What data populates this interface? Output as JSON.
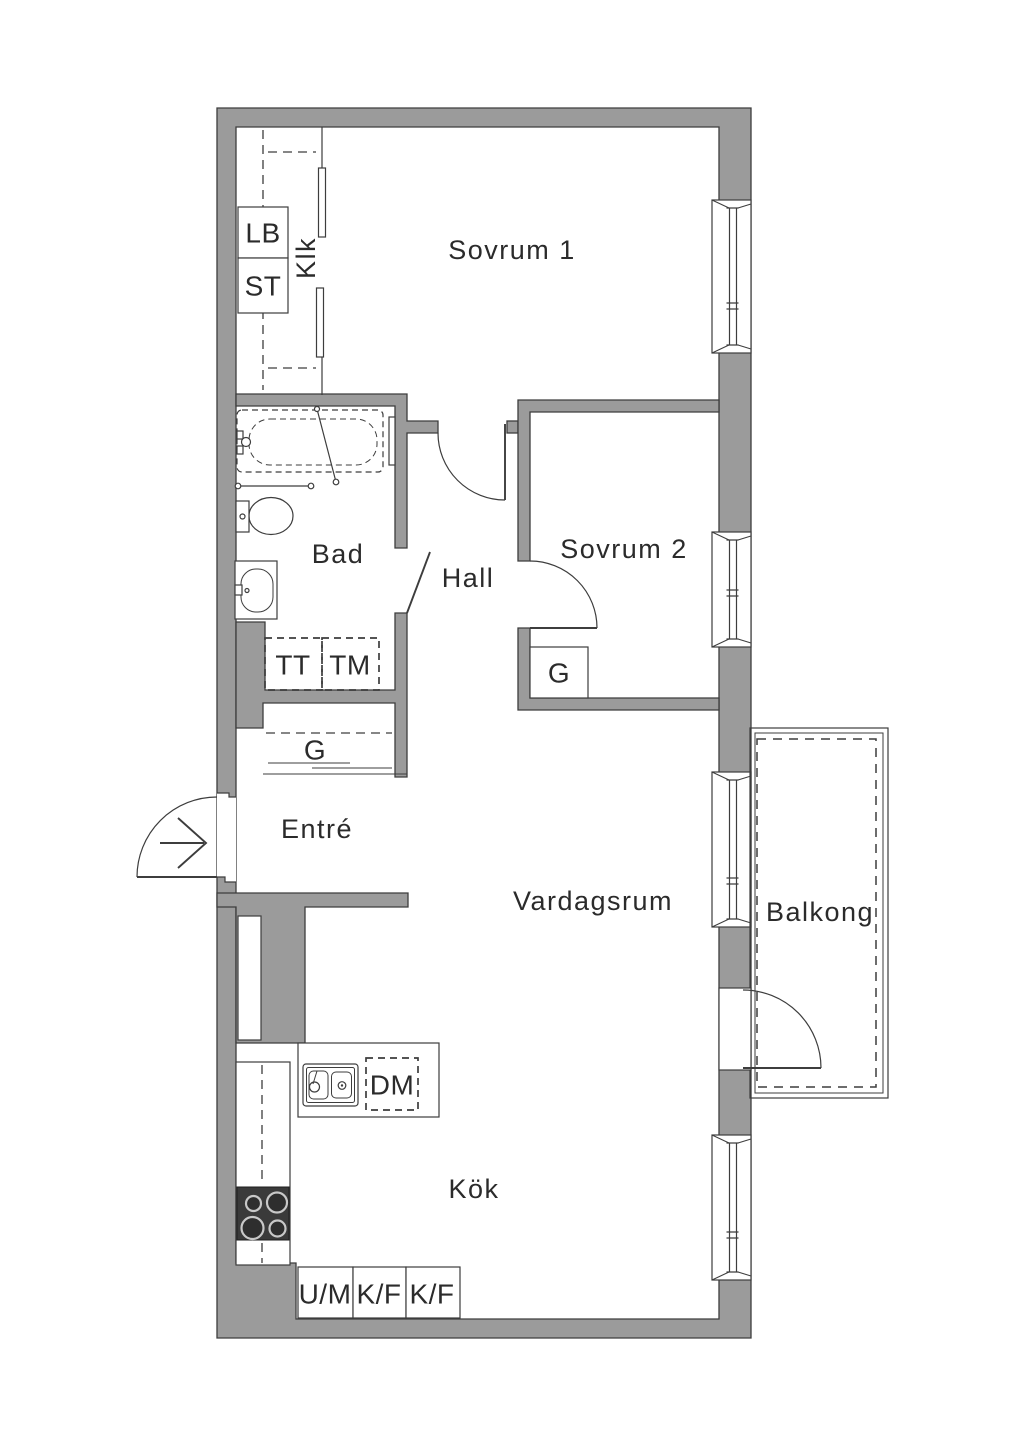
{
  "plan": {
    "rooms": {
      "sovrum1": "Sovrum 1",
      "sovrum2": "Sovrum 2",
      "bad": "Bad",
      "hall": "Hall",
      "klk": "Klk",
      "entre": "Entré",
      "vardagsrum": "Vardagsrum",
      "balkong": "Balkong",
      "kok": "Kök"
    },
    "fixtures": {
      "lb": "LB",
      "st": "ST",
      "tt": "TT",
      "tm": "TM",
      "g_hall": "G",
      "g_sovrum2": "G",
      "dm": "DM",
      "um": "U/M",
      "kf1": "K/F",
      "kf2": "K/F"
    },
    "colors": {
      "wall": "#9b9b9b",
      "outline": "#3d3d3d",
      "text": "#2b2b2b",
      "background": "#ffffff"
    }
  }
}
